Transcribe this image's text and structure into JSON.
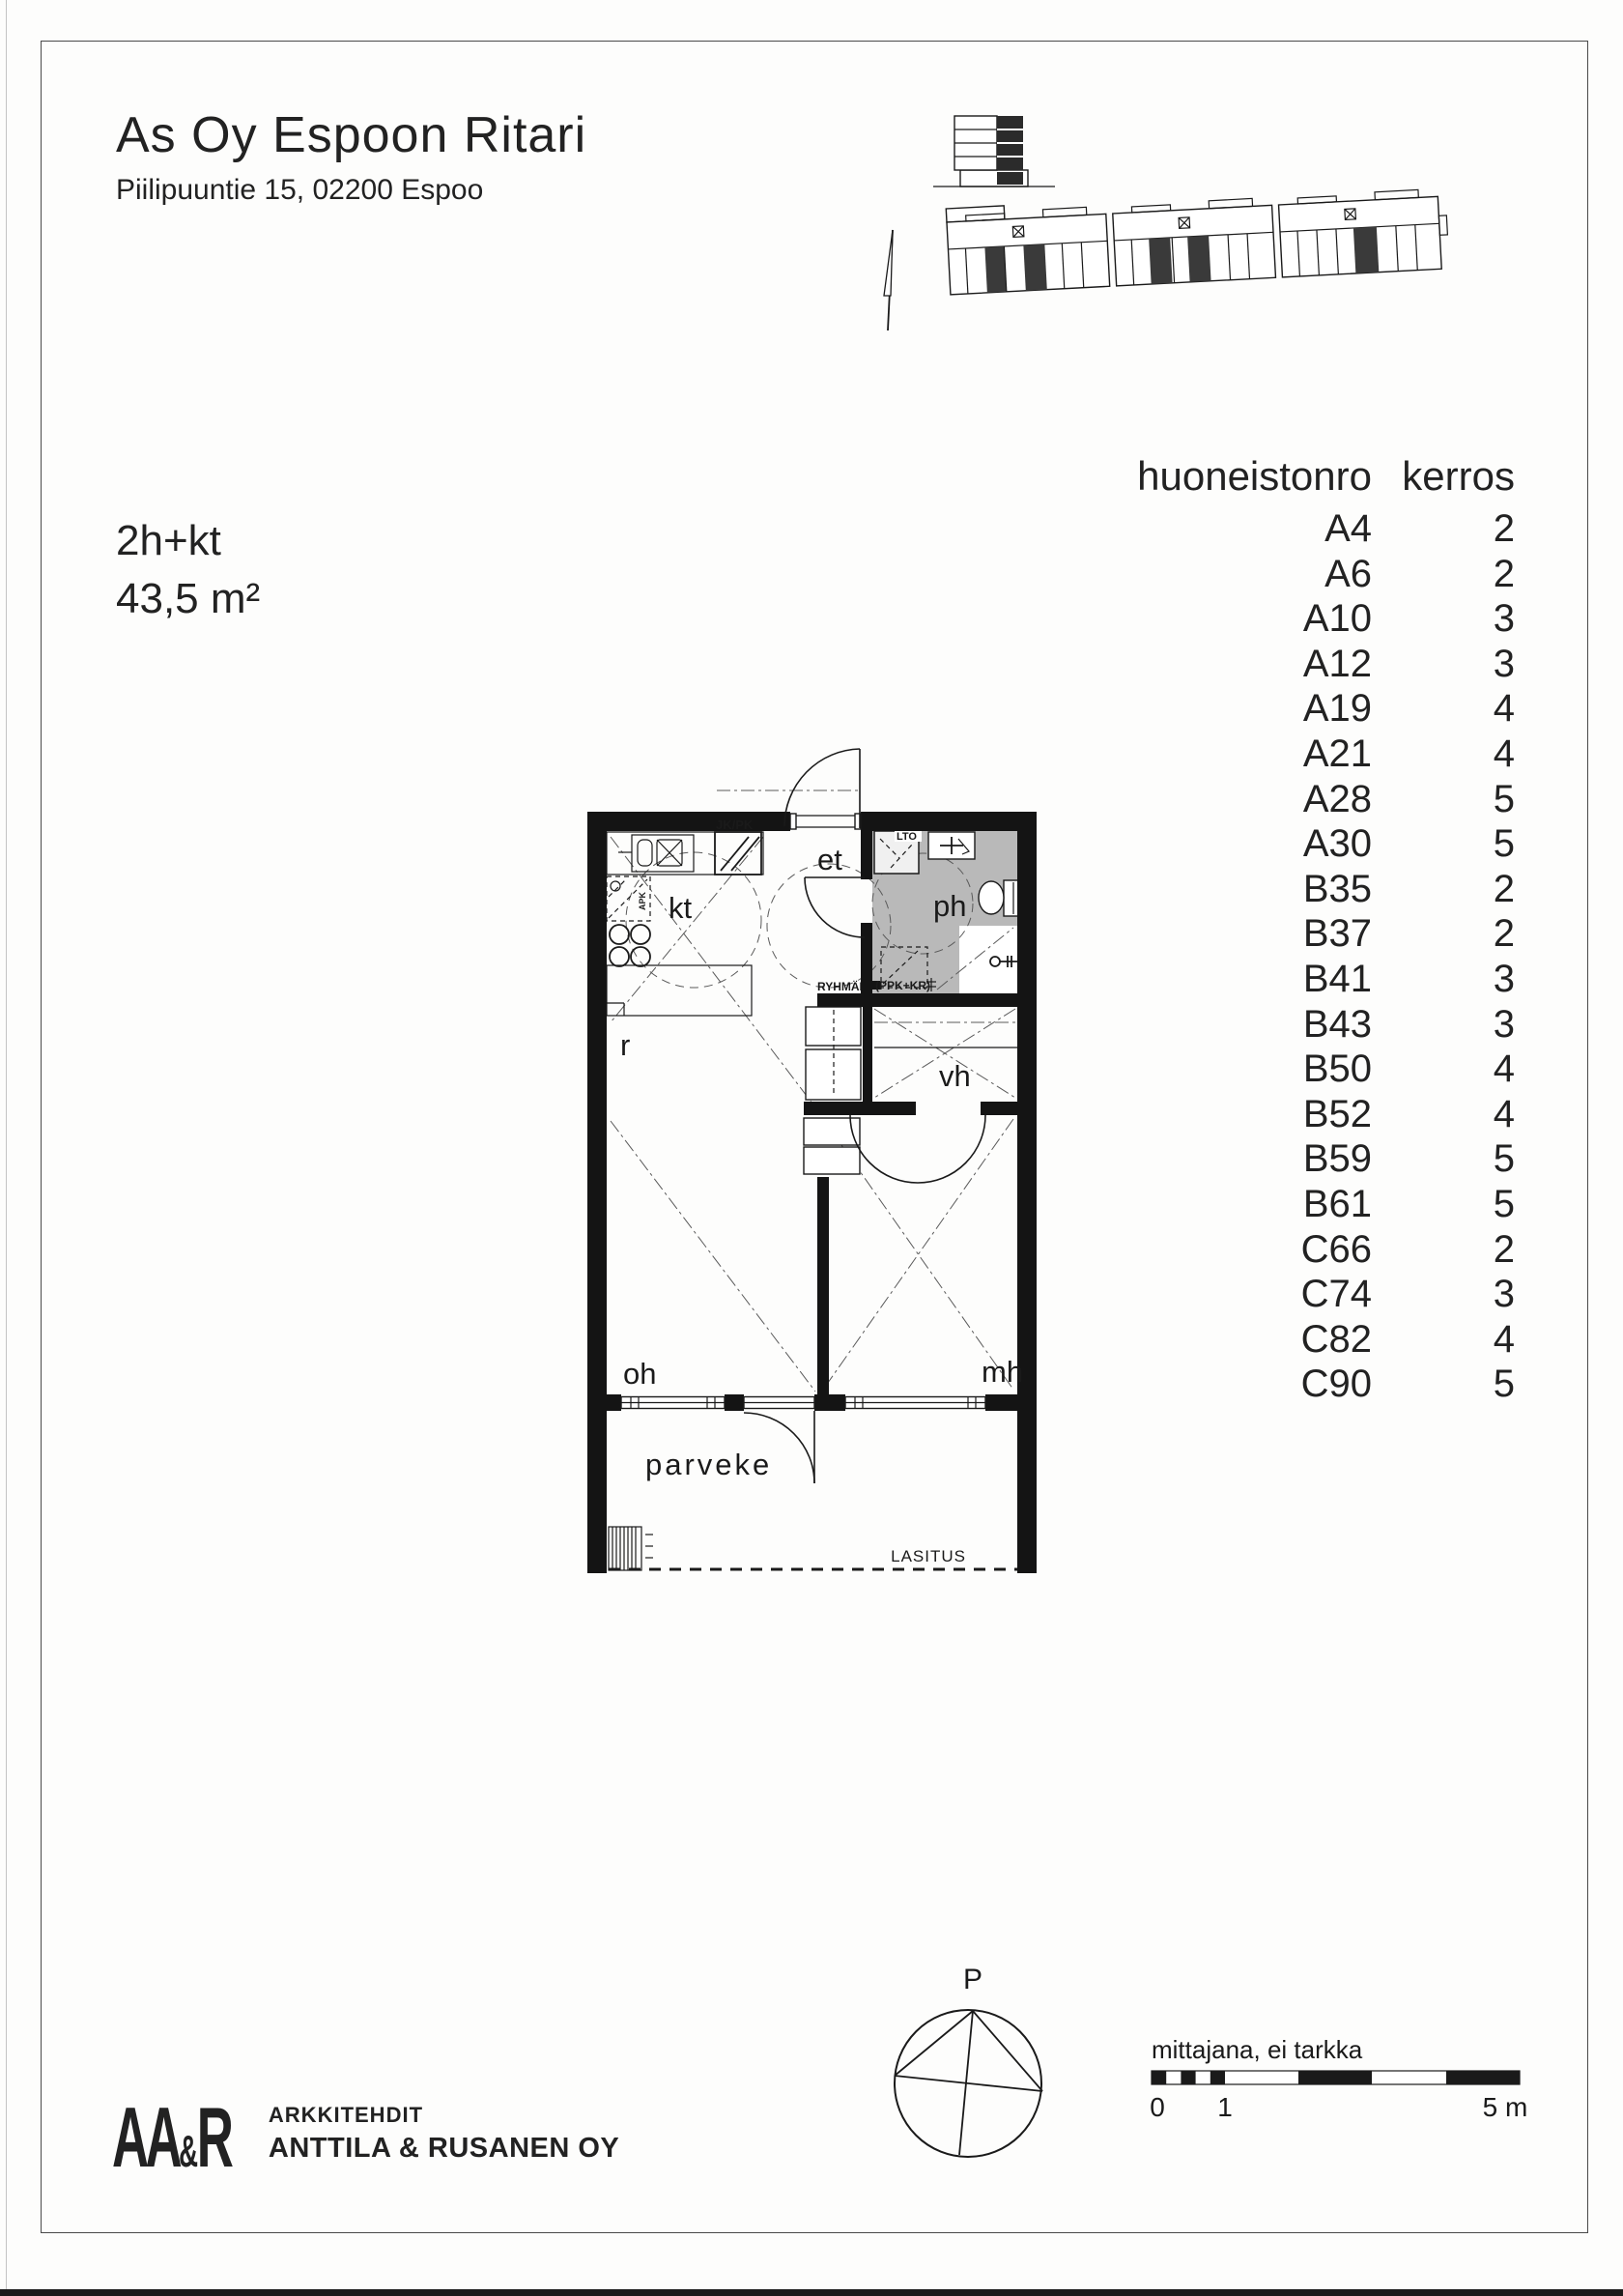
{
  "header": {
    "title": "As Oy Espoon Ritari",
    "address": "Piilipuuntie 15, 02200 Espoo"
  },
  "apartment_info": {
    "type": "2h+kt",
    "area": "43,5 m²"
  },
  "apartment_table": {
    "col_apartment": "huoneistonro",
    "col_floor": "kerros",
    "rows": [
      {
        "apt": "A4",
        "floor": "2"
      },
      {
        "apt": "A6",
        "floor": "2"
      },
      {
        "apt": "A10",
        "floor": "3"
      },
      {
        "apt": "A12",
        "floor": "3"
      },
      {
        "apt": "A19",
        "floor": "4"
      },
      {
        "apt": "A21",
        "floor": "4"
      },
      {
        "apt": "A28",
        "floor": "5"
      },
      {
        "apt": "A30",
        "floor": "5"
      },
      {
        "apt": "B35",
        "floor": "2"
      },
      {
        "apt": "B37",
        "floor": "2"
      },
      {
        "apt": "B41",
        "floor": "3"
      },
      {
        "apt": "B43",
        "floor": "3"
      },
      {
        "apt": "B50",
        "floor": "4"
      },
      {
        "apt": "B52",
        "floor": "4"
      },
      {
        "apt": "B59",
        "floor": "5"
      },
      {
        "apt": "B61",
        "floor": "5"
      },
      {
        "apt": "C66",
        "floor": "2"
      },
      {
        "apt": "C74",
        "floor": "3"
      },
      {
        "apt": "C82",
        "floor": "4"
      },
      {
        "apt": "C90",
        "floor": "5"
      }
    ]
  },
  "floor_plan": {
    "rooms": {
      "kt": "kt",
      "et": "et",
      "ph": "ph",
      "vh": "vh",
      "oh": "oh",
      "mh": "mh",
      "r": "r",
      "parveke": "parveke"
    },
    "fixtures": {
      "jk_pk": "JK/PK",
      "lto": "LTO",
      "ryhmak": "RYHMÄK",
      "ppk_kr": "(PPK+KR)",
      "apk": "APK",
      "lasitus": "LASITUS"
    },
    "bath_floor_color": "#b9b9b9"
  },
  "compass": {
    "north_label": "P"
  },
  "scale_bar": {
    "caption": "mittajana, ei tarkka",
    "tick_0": "0",
    "tick_1": "1",
    "tick_5": "5 m"
  },
  "logo": {
    "mark_aa": "AA",
    "mark_amp": "&",
    "mark_r": "R",
    "line1": "ARKKITEHDIT",
    "line2": "ANTTILA & RUSANEN OY"
  }
}
